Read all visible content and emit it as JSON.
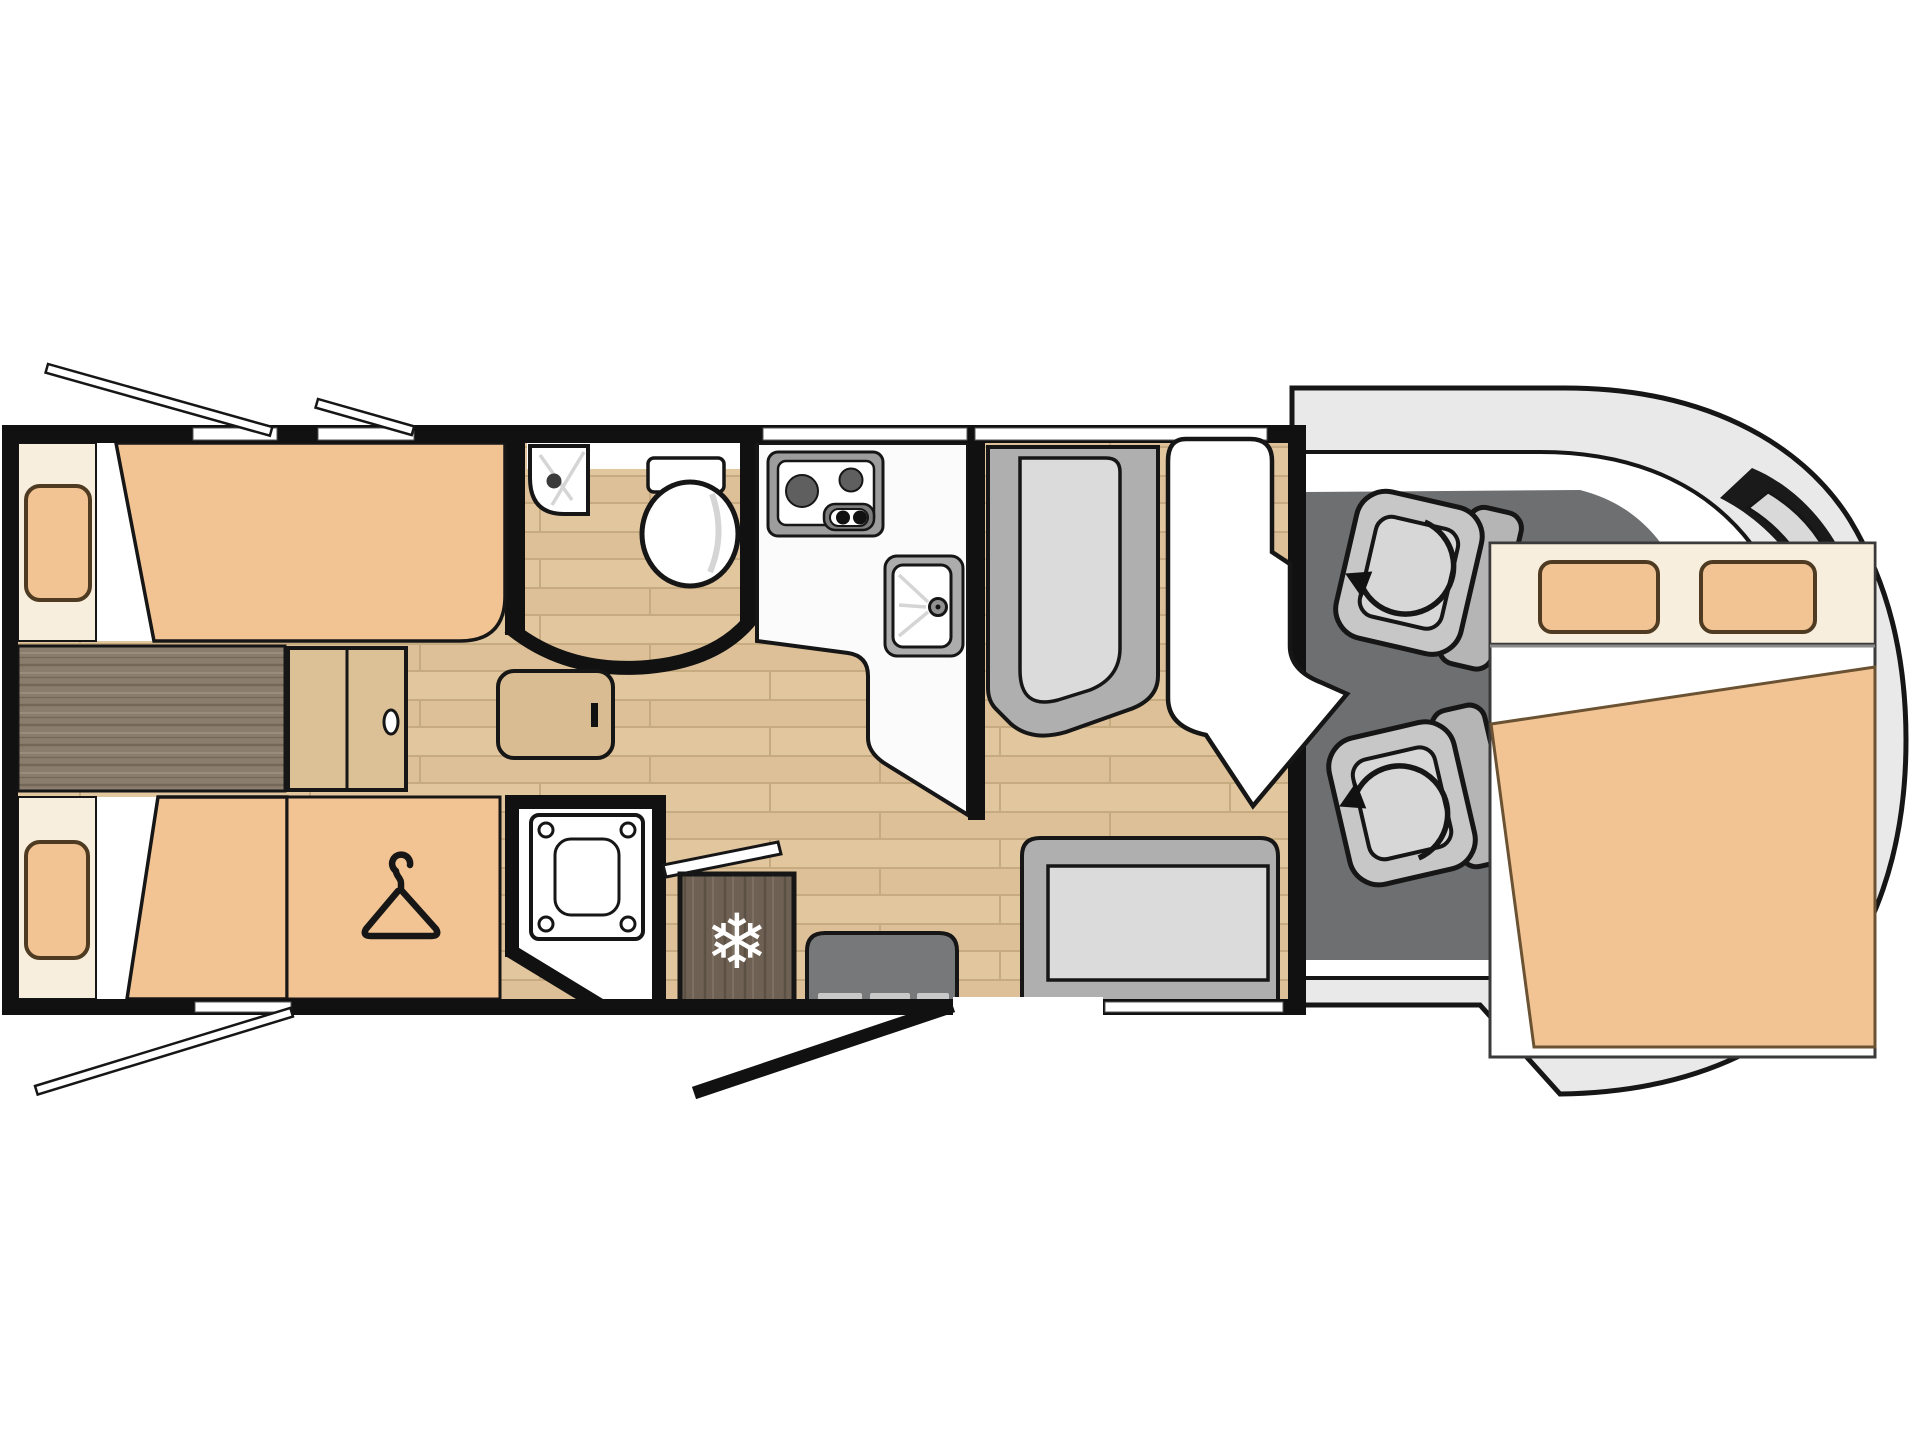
{
  "title": "Overcab motorhome floor plan – rear twin single beds, central washroom, face-to-face lounge",
  "icons": {
    "snowflake_glyph": "❄",
    "hanger": "clothes-hanger-icon",
    "rotation_arrow": "swivel-rotation-arrow-icon"
  },
  "colors": {
    "background": "#ffffff",
    "outline": "#161616",
    "wall": "#111111",
    "white": "#ffffff",
    "cream": "#f8eedd",
    "peach": "#f3c493",
    "peach_outline": "#4f3b22",
    "blanket_outline": "#6b5233",
    "floor_base": "#e2c69e",
    "floor_shade": "#d8bb92",
    "floor_line": "#c6aa80",
    "dark_wood": "#8a7d6e",
    "dark_wood_line": "#746757",
    "dark_wood_hi": "#9c8f7f",
    "fridge_wood": "#6e6052",
    "fridge_line": "#5b5044",
    "fridge_hi": "#7e7163",
    "cabinet_wood": "#dcc096",
    "table_wood": "#d9bc92",
    "counter": "#fbfbfb",
    "appliance_frame": "#9d9d9d",
    "burner": "#5f5f5f",
    "knob_panel": "#7c7c7c",
    "sink_frame": "#acacac",
    "tap": "#909090",
    "streak": "#d5d5d5",
    "drain": "#3a3a3a",
    "cab_body": "#e9e9e9",
    "cab_floor": "#6e6f71",
    "seat_body": "#c7c7c7",
    "seat_back": "#b5b5b5",
    "seat_cushion": "#d7d7d7",
    "bench_frame": "#afafaf",
    "bench_cushion": "#dbdbdb",
    "step": "#77787a",
    "step_tread": "#c9c9c9",
    "mirror_dark": "#1a1a1a",
    "mirror_wing": "#d9d9d9",
    "bed_outline": "#3a3a3a",
    "window_edge": "#555555",
    "divider_gray": "#8a8a8a"
  },
  "inventory": {
    "rear_bedroom": [
      "twin single bed top",
      "twin single bed bottom",
      "bedside chest",
      "steps cabinet",
      "occasional table",
      "wardrobe with hanger"
    ],
    "bathroom": [
      "corner shower tray",
      "toilet",
      "vanity strip",
      "separate shower cubicle",
      "bathroom door"
    ],
    "kitchen": [
      "worktop",
      "two-burner hob",
      "sink with tap",
      "refrigerator"
    ],
    "lounge": [
      "forward bench seat",
      "rear bench seat",
      "contoured lounge seat",
      "entry step",
      "entrance door"
    ],
    "cab": [
      "driver swivel seat",
      "passenger swivel seat",
      "windscreen",
      "wing mirror"
    ],
    "front": [
      "overcab double bed",
      "pillow left",
      "pillow right",
      "duvet"
    ],
    "exterior": [
      "window stay rear-left long",
      "window stay rear-left short",
      "window stay bottom-left",
      "windows"
    ]
  }
}
